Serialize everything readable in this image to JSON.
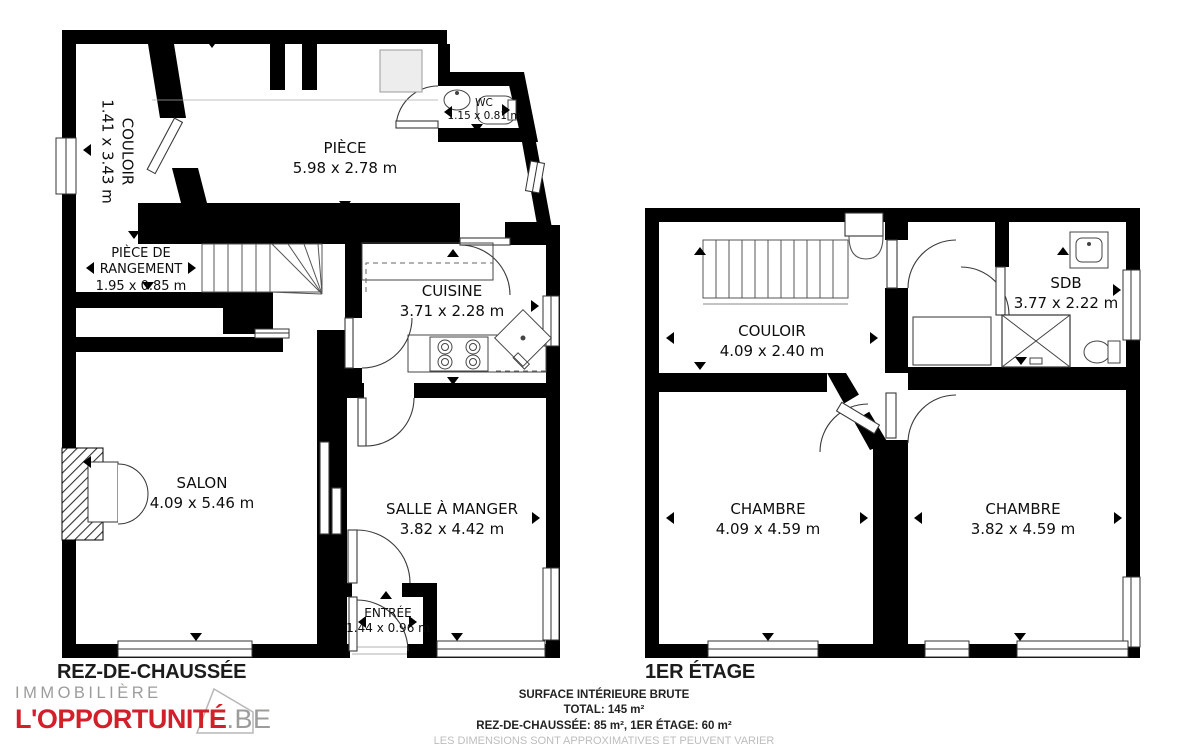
{
  "floors": [
    {
      "label": "REZ-DE-CHAUSSÉE",
      "rooms": {
        "couloir": {
          "name": "COULOIR",
          "dims": "1.41 x 3.43 m"
        },
        "piece": {
          "name": "PIÈCE",
          "dims": "5.98 x 2.78 m"
        },
        "wc": {
          "name": "WC",
          "dims": "1.15 x 0.81 m"
        },
        "rangement": {
          "name": "PIÈCE DE RANGEMENT",
          "dims": "1.95 x 0.85 m"
        },
        "cuisine": {
          "name": "CUISINE",
          "dims": "3.71 x 2.28 m"
        },
        "salon": {
          "name": "SALON",
          "dims": "4.09 x 5.46 m"
        },
        "salle_a_manger": {
          "name": "SALLE À MANGER",
          "dims": "3.82 x 4.42 m"
        },
        "entree": {
          "name": "ENTRÉE",
          "dims": "1.44 x 0.96 m"
        }
      }
    },
    {
      "label": "1ER ÉTAGE",
      "rooms": {
        "couloir": {
          "name": "COULOIR",
          "dims": "4.09 x 2.40 m"
        },
        "sdb": {
          "name": "SDB",
          "dims": "3.77 x 2.22 m"
        },
        "chambre_gauche": {
          "name": "CHAMBRE",
          "dims": "4.09 x 4.59 m"
        },
        "chambre_droite": {
          "name": "CHAMBRE",
          "dims": "3.82 x 4.59 m"
        }
      }
    }
  ],
  "footer": {
    "line1": "SURFACE INTÉRIEURE BRUTE",
    "line2": "TOTAL: 145 m²",
    "line3": "REZ-DE-CHAUSSÉE: 85 m², 1ER ÉTAGE: 60 m²",
    "line4": "LES DIMENSIONS SONT APPROXIMATIVES ET PEUVENT VARIER"
  },
  "logo": {
    "top": "IMMOBILIÈRE",
    "main": "L'OPPORTUNITÉ",
    "tld": ".BE",
    "accent_color": "#d2202a",
    "gray_color": "#9c9c9b"
  },
  "icons": [
    "stairs-icon",
    "stove-icon",
    "sink-icon",
    "toilet-icon",
    "shower-icon",
    "fireplace-icon",
    "house-icon"
  ]
}
